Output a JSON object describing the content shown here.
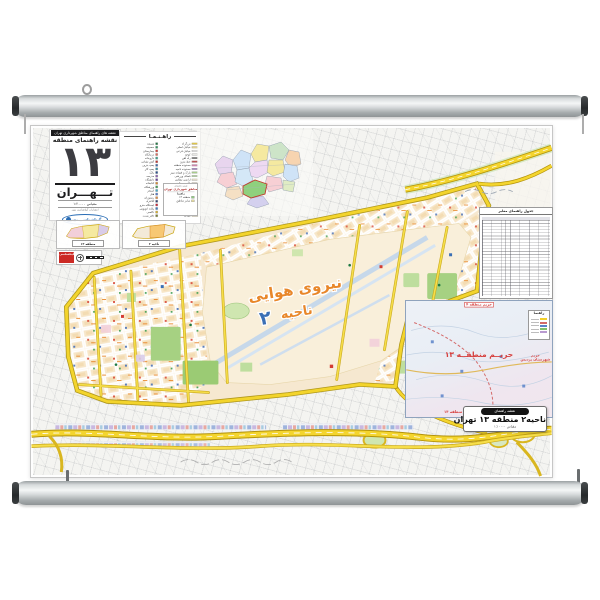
{
  "title_panel": {
    "series": "نقشه های راهنمای مناطق شهرداری تهران",
    "heading": "نقشه راهنمای منطقه",
    "district_number": "۱۳",
    "city": "تـــهـــران",
    "scale": "مقیاس ۱:۲۰۰۰۰",
    "publisher_line": "انتشارات گیتاشناسی نوین",
    "logo": "گیتاشناسی نوین"
  },
  "legend": {
    "title": "راهـنـمـا",
    "areas": [
      {
        "t": "بزرگراه",
        "c": "#f2cf2a"
      },
      {
        "t": "خیابان اصلی",
        "c": "#f7e28a"
      },
      {
        "t": "خیابان فرعی",
        "c": "#ffffff"
      },
      {
        "t": "کوچه",
        "c": "#f0f0ec"
      },
      {
        "t": "راه آهن",
        "c": "#6a6a6a"
      },
      {
        "t": "خط مترو",
        "c": "#c43a3a"
      },
      {
        "t": "محدوده منطقه",
        "c": "#e07ab0"
      },
      {
        "t": "محدوده ناحیه",
        "c": "#a87ec9"
      },
      {
        "t": "پارک و فضای سبز",
        "c": "#a8d386"
      },
      {
        "t": "فضای ورزشی",
        "c": "#bfe3a8"
      },
      {
        "t": "اراضی نظامی",
        "c": "#f6ecd2"
      },
      {
        "t": "بافت مسکونی",
        "c": "#f7e3c4"
      },
      {
        "t": "مراکز آموزشی",
        "c": "#f2cfd9"
      },
      {
        "t": "مراکز درمانی",
        "c": "#d9cce8"
      },
      {
        "t": "مراکز اداری",
        "c": "#c9d8ef"
      },
      {
        "t": "مراکز تجاری",
        "c": "#f0c9a8"
      },
      {
        "t": "مراکز مذهبی",
        "c": "#cfe8d7"
      },
      {
        "t": "گورستان",
        "c": "#d8e8cf"
      },
      {
        "t": "اراضی بایر",
        "c": "#ecece2"
      },
      {
        "t": "رودخانه و مسیل",
        "c": "#b8d8ef"
      },
      {
        "t": "میدان",
        "c": "#f5dfa8"
      }
    ],
    "symbols": [
      {
        "t": "مسجد",
        "c": "#1e7a43"
      },
      {
        "t": "حسینیه",
        "c": "#2e9960"
      },
      {
        "t": "بیمارستان",
        "c": "#d43c32"
      },
      {
        "t": "درمانگاه",
        "c": "#e06a5a"
      },
      {
        "t": "داروخانه",
        "c": "#37a08a"
      },
      {
        "t": "آتش نشانی",
        "c": "#c42f28"
      },
      {
        "t": "پمپ بنزین",
        "c": "#3b66ad"
      },
      {
        "t": "پمپ گاز",
        "c": "#2f8fa8"
      },
      {
        "t": "بانک",
        "c": "#274f8e"
      },
      {
        "t": "مدرسه",
        "c": "#8a5fb0"
      },
      {
        "t": "دانشگاه",
        "c": "#6a3fa0"
      },
      {
        "t": "کتابخانه",
        "c": "#d98a2b"
      },
      {
        "t": "ورزشگاه",
        "c": "#3f9e53"
      },
      {
        "t": "استخر",
        "c": "#3fa9c9"
      },
      {
        "t": "هتل",
        "c": "#5577c9"
      },
      {
        "t": "رستوران",
        "c": "#e08a3c"
      },
      {
        "t": "کلانتری",
        "c": "#2d3f73"
      },
      {
        "t": "ایستگاه مترو",
        "c": "#cc2233"
      },
      {
        "t": "پایانه اتوبوس",
        "c": "#3a7ac2"
      },
      {
        "t": "تاکسی",
        "c": "#d9b02a"
      },
      {
        "t": "دفتر پست",
        "c": "#7a7f2e"
      }
    ]
  },
  "tehran_inset": {
    "header": "نقشه راهنمای",
    "title": "مناطق شهرداری تهران",
    "legend_title": "راهنما",
    "rows": [
      {
        "c": "#8fd07e",
        "t": "منطقه ۱۳"
      },
      {
        "c": "#f5e9a0",
        "t": "سایر مناطق"
      }
    ]
  },
  "locators": [
    {
      "label": "منطقه ۱۳"
    },
    {
      "label": "ناحیه ۲"
    }
  ],
  "scalebox": {
    "brand": "گیتاشناسی",
    "scale": "۱:۱۰۰۰۰"
  },
  "main_map": {
    "airbase_line1": "نیروی هوایی",
    "airbase_line2": "ناحیه",
    "zone_number": "۲"
  },
  "street_index": {
    "title": "جدول راهنمای معابر"
  },
  "harim": {
    "top": "حریم منطقه ۴",
    "center": "حریــم منطقــه ۱۳",
    "right1": "حریم",
    "right2": "شهرستان پردیس",
    "bottom": "حریم منطقه ۱۴",
    "legend_title": "راهنما",
    "legend_rows": [
      {
        "c": "#f2cf2a"
      },
      {
        "c": "#d46a6a"
      },
      {
        "c": "#5b83c9"
      },
      {
        "c": "#7fbf6a"
      },
      {
        "c": "#b89ad0"
      }
    ]
  },
  "cartouche": {
    "header": "نقشه راهنمای",
    "title": "ناحیه۲ منطقه ۱۳ تهران",
    "scale": "مقیاس ۱:۱۰۰۰۰"
  }
}
